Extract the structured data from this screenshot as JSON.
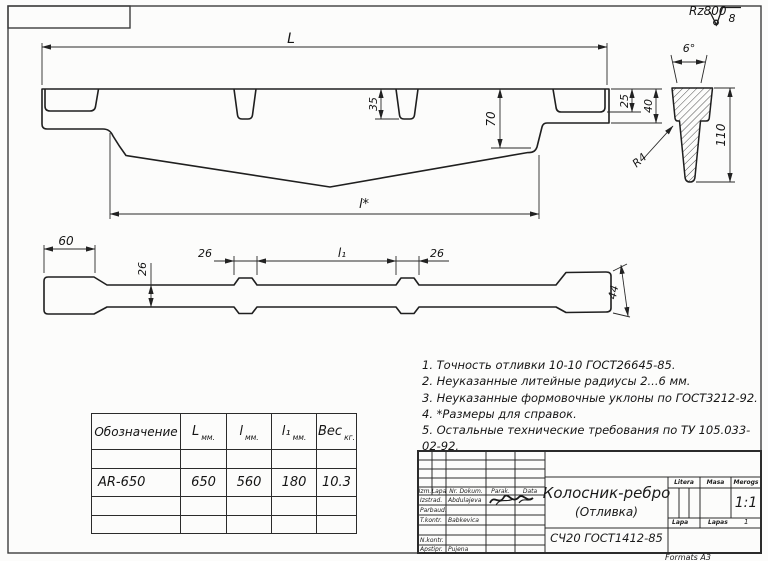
{
  "roughness": {
    "label": "Rz800",
    "value": "8"
  },
  "dims": {
    "side": {
      "overall_length": "L",
      "pocket_depth": "25",
      "end_height": "40",
      "slot_depth": "35",
      "mid_height": "70",
      "ref_length": "l*"
    },
    "section": {
      "draft_angle": "6°",
      "fillet": "R4",
      "height": "110"
    },
    "plan": {
      "end_width": "60",
      "bar_width": "26",
      "boss_left": "26",
      "between": "l₁",
      "boss_right": "26",
      "right_end_width": "44"
    }
  },
  "notes": [
    "1. Точность отливки 10-10 ГОСТ26645-85.",
    "2. Неуказанные литейные радиусы 2...6 мм.",
    "3. Неуказанные формовочные уклоны по ГОСТ3212-92.",
    "4. *Размеры для справок.",
    "5. Остальные технические требования по ТУ 105.033-02-92."
  ],
  "spec_table": {
    "columns": [
      {
        "label": "Обозначение",
        "unit": ""
      },
      {
        "label": "L",
        "unit": "мм."
      },
      {
        "label": "l",
        "unit": "мм."
      },
      {
        "label": "l₁",
        "unit": "мм."
      },
      {
        "label": "Вес",
        "unit": "кг."
      }
    ],
    "row": {
      "designation": "AR-650",
      "L": "650",
      "l": "560",
      "l1": "180",
      "weight": "10.3"
    }
  },
  "title_block": {
    "header": {
      "izm": "Izm.",
      "lapa": "Lapa",
      "nr_dokum": "Nr. Dokum.",
      "parak": "Parak.",
      "data": "Data"
    },
    "rows": [
      {
        "role": "Izstrad.",
        "name": "Abdulajeva"
      },
      {
        "role": "Parbaud.",
        "name": ""
      },
      {
        "role": "T.kontr.",
        "name": "Babkevica"
      },
      {
        "role": "N.kontr.",
        "name": ""
      },
      {
        "role": "Apstipr.",
        "name": "Pujena"
      }
    ],
    "title": "Колосник-ребро",
    "subtitle": "(Отливка)",
    "material": "СЧ20 ГОСТ1412-85",
    "litera_label": "Litera",
    "masa_label": "Masa",
    "merogs_label": "Merogs",
    "scale": "1:1",
    "sheet_label": "Lapa",
    "sheets_label": "Lapas",
    "sheets_value": "1",
    "format": "Formats A3"
  }
}
